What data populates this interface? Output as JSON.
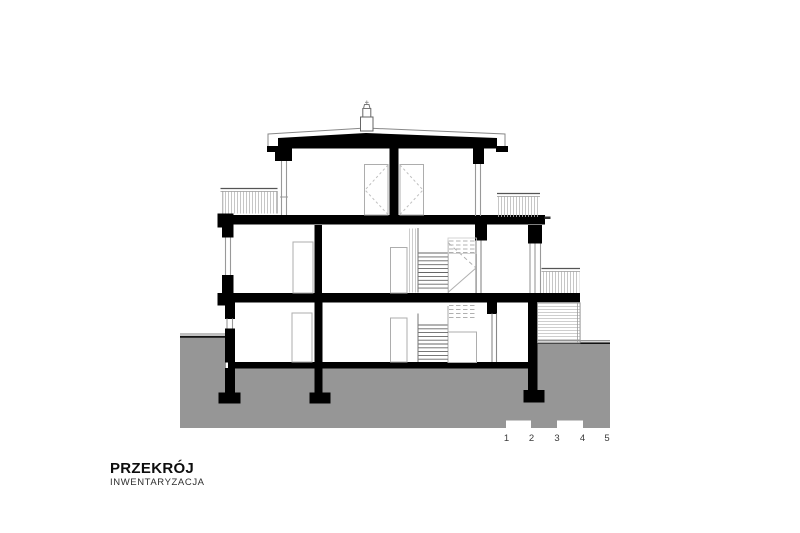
{
  "page": {
    "background": "#ffffff"
  },
  "drawing": {
    "name": "building-cross-section",
    "colors": {
      "ink": "#000000",
      "ground_fill": "#969696",
      "light_line": "#b5b5b5"
    }
  },
  "title_block": {
    "title": "PRZEKRÓJ",
    "subtitle": "INWENTARYZACJA"
  },
  "scale_bar": {
    "unit_labels": [
      "1",
      "2",
      "3",
      "4",
      "5"
    ]
  }
}
